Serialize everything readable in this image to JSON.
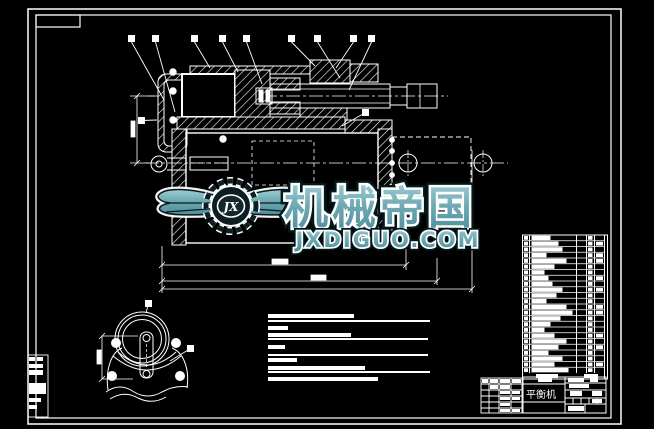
{
  "watermark": {
    "logo_text": "JX",
    "brand": "机械帝国",
    "domain": "JXDIGUO.COM",
    "teal_light": "#9ccdd3",
    "teal_mid": "#6fa9b4",
    "teal_dark": "#4d8d9c",
    "outline_dark": "#07181b"
  },
  "title_block": {
    "product_name": "平衡机"
  },
  "colors": {
    "background": "#000000",
    "line": "#ffffff"
  },
  "balloons": {
    "top_row": [
      {
        "x": 128,
        "tx": 164,
        "ty": 100
      },
      {
        "x": 152,
        "tx": 175,
        "ty": 112
      },
      {
        "x": 191,
        "tx": 210,
        "ty": 68
      },
      {
        "x": 219,
        "tx": 238,
        "ty": 72
      },
      {
        "x": 243,
        "tx": 262,
        "ty": 84
      },
      {
        "x": 288,
        "tx": 315,
        "ty": 66
      },
      {
        "x": 314,
        "tx": 340,
        "ty": 78
      },
      {
        "x": 350,
        "tx": 336,
        "ty": 68
      },
      {
        "x": 368,
        "tx": 349,
        "ty": 90
      }
    ],
    "top_row_y": 35,
    "side": [
      {
        "x": 138,
        "y": 117,
        "tx": 157,
        "ty": 120
      },
      {
        "x": 362,
        "y": 109,
        "tx": 342,
        "ty": 126
      },
      {
        "x": 145,
        "y": 300,
        "tx": 146,
        "ty": 313
      },
      {
        "x": 187,
        "y": 345,
        "tx": 170,
        "ty": 361
      }
    ],
    "size": 7
  },
  "notes_block": {
    "x": 268,
    "bars": [
      {
        "y": 314,
        "w": 86,
        "h": 4
      },
      {
        "y": 320,
        "w": 162,
        "h": 2
      },
      {
        "y": 326,
        "w": 20,
        "h": 4
      },
      {
        "y": 333,
        "w": 83,
        "h": 4
      },
      {
        "y": 338,
        "w": 160,
        "h": 2
      },
      {
        "y": 345,
        "w": 17,
        "h": 4
      },
      {
        "y": 354,
        "w": 160,
        "h": 2
      },
      {
        "y": 358,
        "w": 29,
        "h": 4
      },
      {
        "y": 366,
        "w": 97,
        "h": 4
      },
      {
        "y": 371,
        "w": 162,
        "h": 2
      },
      {
        "y": 377,
        "w": 110,
        "h": 4
      }
    ]
  },
  "parts_table": {
    "x": 522,
    "top": 235,
    "row_h": 5.75,
    "row_count": 24,
    "name_widths": [
      18,
      26,
      30,
      14,
      34,
      22,
      12,
      16,
      20,
      30,
      24,
      14,
      34,
      40,
      28,
      18,
      12,
      22,
      34,
      26,
      16,
      30,
      22,
      36
    ],
    "material_rows": [
      1,
      3,
      4,
      7,
      9,
      12,
      13,
      17,
      19,
      22
    ]
  },
  "dimensions": {
    "blobs": [
      {
        "x": 272,
        "y": 259,
        "w": 16,
        "h": 5
      },
      {
        "x": 311,
        "y": 275,
        "w": 15,
        "h": 5
      },
      {
        "x": 131,
        "y": 121,
        "w": 4,
        "h": 16
      },
      {
        "x": 97,
        "y": 350,
        "w": 4,
        "h": 14
      }
    ]
  }
}
